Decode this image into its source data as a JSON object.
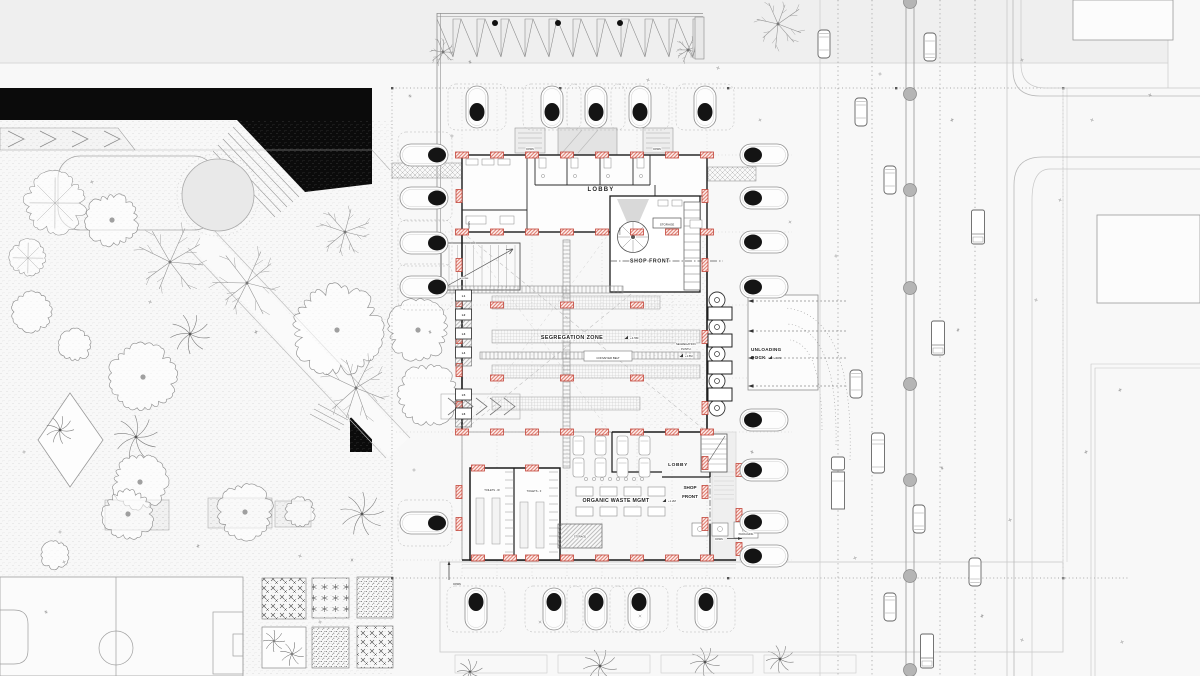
{
  "drawing": {
    "type": "architectural ground-floor site plan",
    "colors": {
      "ink": "#1b1b1b",
      "light_line": "#9a9a9a",
      "faint_line": "#c8c8c8",
      "column_red": "#c2453a",
      "column_red_fill": "#fdeeec",
      "gray_fill": "#e6e6e6",
      "band_gray": "#efefef",
      "median_circle": "#b5b5b5",
      "black_mass": "#0b0b0b"
    }
  },
  "labels": [
    {
      "id": "lobby-upper",
      "text": "LOBBY",
      "x": 601,
      "y": 191,
      "size": 6,
      "weight": 700,
      "spacing": 1.2,
      "halo": true
    },
    {
      "id": "storage-upper",
      "text": "STORAGE",
      "x": 667,
      "y": 225.5,
      "size": 3,
      "weight": 400
    },
    {
      "id": "shop-front-upper",
      "text": "SHOP FRONT",
      "x": 650,
      "y": 262.5,
      "size": 5.2,
      "weight": 700,
      "spacing": 0.6,
      "halo": true
    },
    {
      "id": "segregation-zone",
      "text": "SEGREGATION ZONE",
      "x": 572,
      "y": 339,
      "size": 5.4,
      "weight": 700,
      "spacing": 0.4,
      "halo": true
    },
    {
      "id": "segregation-zone-level",
      "text": "+1.5M",
      "x": 630,
      "y": 339,
      "size": 3,
      "weight": 400,
      "anchor": "start",
      "flag": true,
      "halo": true
    },
    {
      "id": "conveyer-belt",
      "text": "CONVEYER BELT",
      "x": 608,
      "y": 358.8,
      "size": 2.8,
      "weight": 400
    },
    {
      "id": "segregation-plinth-1",
      "text": "SEGREGATION",
      "x": 676,
      "y": 345,
      "size": 2.7,
      "weight": 400,
      "anchor": "start",
      "halo": true
    },
    {
      "id": "segregation-plinth-2",
      "text": "PLINTH",
      "x": 681,
      "y": 350,
      "size": 2.7,
      "weight": 400,
      "anchor": "start",
      "halo": true
    },
    {
      "id": "segregation-plinth-level",
      "text": "+1.5M",
      "x": 685,
      "y": 357,
      "size": 2.7,
      "weight": 400,
      "anchor": "start",
      "flag": true,
      "halo": true
    },
    {
      "id": "unloading-dock-1",
      "text": "UNLOADING",
      "x": 751,
      "y": 351,
      "size": 4.6,
      "weight": 700,
      "anchor": "start",
      "spacing": 0.3
    },
    {
      "id": "unloading-dock-2",
      "text": "DOCK",
      "x": 751,
      "y": 359,
      "size": 4.6,
      "weight": 700,
      "anchor": "start",
      "spacing": 0.3
    },
    {
      "id": "unloading-dock-level",
      "text": "+0.0M",
      "x": 774,
      "y": 359,
      "size": 2.6,
      "weight": 400,
      "anchor": "start",
      "flag": true
    },
    {
      "id": "organic-waste",
      "text": "ORGANIC WASTE MGMT",
      "x": 616,
      "y": 502,
      "size": 5.2,
      "weight": 700,
      "spacing": 0.3,
      "halo": true
    },
    {
      "id": "organic-waste-level",
      "text": "+1.2M",
      "x": 668,
      "y": 502,
      "size": 2.8,
      "weight": 400,
      "anchor": "start",
      "flag": true,
      "halo": true
    },
    {
      "id": "lobby-lower",
      "text": "LOBBY",
      "x": 678,
      "y": 466,
      "size": 4.8,
      "weight": 700,
      "spacing": 0.6,
      "halo": true
    },
    {
      "id": "shop-front-lower-1",
      "text": "SHOP",
      "x": 690,
      "y": 489,
      "size": 4.6,
      "weight": 700,
      "halo": true
    },
    {
      "id": "shop-front-lower-2",
      "text": "FRONT",
      "x": 690,
      "y": 498,
      "size": 4.6,
      "weight": 700,
      "halo": true
    },
    {
      "id": "toilets-w",
      "text": "TOILETS - W",
      "x": 492,
      "y": 491,
      "size": 2.6,
      "weight": 400,
      "halo": true
    },
    {
      "id": "toilets-f",
      "text": "TOILETS - F",
      "x": 534,
      "y": 492,
      "size": 2.6,
      "weight": 400,
      "halo": true
    },
    {
      "id": "storage-lower",
      "text": "STORAGE",
      "x": 580,
      "y": 537.5,
      "size": 2.5,
      "weight": 400,
      "halo": true
    },
    {
      "id": "packaging",
      "text": "PACKAGING",
      "x": 746,
      "y": 535,
      "size": 2.5,
      "weight": 400,
      "halo": true
    },
    {
      "id": "down-canopy-left",
      "text": "DOWN",
      "x": 530,
      "y": 150,
      "size": 2.4,
      "weight": 400,
      "halo": true
    },
    {
      "id": "down-canopy-right",
      "text": "DOWN",
      "x": 657,
      "y": 150,
      "size": 2.4,
      "weight": 400,
      "halo": true
    },
    {
      "id": "down-ramp",
      "text": "DOWN",
      "x": 470,
      "y": 225,
      "size": 2.4,
      "weight": 400,
      "rotate": -90
    },
    {
      "id": "down-core",
      "text": "DOWN",
      "x": 620.5,
      "y": 231,
      "size": 2.2,
      "weight": 400,
      "rotate": -90
    },
    {
      "id": "down-wall",
      "text": "DOWN",
      "x": 465,
      "y": 279,
      "size": 2.1,
      "weight": 400,
      "halo": true
    },
    {
      "id": "down-south",
      "text": "DOWN",
      "x": 457,
      "y": 585,
      "size": 2.4,
      "weight": 400
    },
    {
      "id": "down-east",
      "text": "DOWN",
      "x": 719,
      "y": 540,
      "size": 2.4,
      "weight": 400,
      "halo": true
    }
  ],
  "lift_cells": {
    "x": 463.5,
    "labels": [
      {
        "t": "L1",
        "y": 296
      },
      {
        "t": "L2",
        "y": 315
      },
      {
        "t": "L3",
        "y": 334
      },
      {
        "t": "L4",
        "y": 353
      },
      {
        "t": "L5",
        "y": 395
      },
      {
        "t": "L6",
        "y": 414
      }
    ]
  },
  "columns": {
    "horizontal": [
      [
        462,
        155
      ],
      [
        497,
        155
      ],
      [
        532,
        155
      ],
      [
        567,
        155
      ],
      [
        602,
        155
      ],
      [
        637,
        155
      ],
      [
        672,
        155
      ],
      [
        707,
        155
      ],
      [
        462,
        232
      ],
      [
        497,
        232
      ],
      [
        532,
        232
      ],
      [
        567,
        232
      ],
      [
        602,
        232
      ],
      [
        637,
        232
      ],
      [
        672,
        232
      ],
      [
        707,
        232
      ],
      [
        497,
        305
      ],
      [
        567,
        305
      ],
      [
        637,
        305
      ],
      [
        497,
        378
      ],
      [
        567,
        378
      ],
      [
        637,
        378
      ],
      [
        462,
        432
      ],
      [
        497,
        432
      ],
      [
        532,
        432
      ],
      [
        567,
        432
      ],
      [
        602,
        432
      ],
      [
        637,
        432
      ],
      [
        672,
        432
      ],
      [
        707,
        432
      ],
      [
        478,
        468
      ],
      [
        532,
        468
      ],
      [
        478,
        558
      ],
      [
        510,
        558
      ],
      [
        532,
        558
      ],
      [
        567,
        558
      ],
      [
        602,
        558
      ],
      [
        637,
        558
      ],
      [
        672,
        558
      ],
      [
        707,
        558
      ]
    ],
    "vertical": [
      [
        459,
        196
      ],
      [
        459,
        265
      ],
      [
        459,
        300
      ],
      [
        459,
        337
      ],
      [
        459,
        370
      ],
      [
        459,
        408
      ],
      [
        459,
        492
      ],
      [
        459,
        524
      ],
      [
        705,
        196
      ],
      [
        705,
        265
      ],
      [
        705,
        337
      ],
      [
        705,
        408
      ],
      [
        705,
        463
      ],
      [
        705,
        492
      ],
      [
        705,
        524
      ],
      [
        739,
        470
      ],
      [
        739,
        515
      ],
      [
        739,
        549
      ]
    ]
  },
  "site_trees": {
    "top": {
      "xs": [
        477,
        552,
        596,
        640,
        705
      ]
    },
    "bottom": {
      "xs": [
        476,
        554,
        596,
        639,
        706
      ]
    },
    "left": {
      "ys": [
        155,
        198,
        243,
        287,
        523
      ]
    },
    "right": {
      "ys": [
        155,
        198,
        242,
        287,
        420,
        470,
        522,
        556
      ]
    }
  },
  "park_trees": [
    {
      "x": 55,
      "y": 203,
      "r": 30,
      "t": "flower"
    },
    {
      "x": 112,
      "y": 220,
      "r": 26,
      "t": "blob",
      "dot": true
    },
    {
      "x": 28,
      "y": 258,
      "r": 18,
      "t": "flower"
    },
    {
      "x": 32,
      "y": 312,
      "r": 20,
      "t": "blob"
    },
    {
      "x": 75,
      "y": 345,
      "r": 16,
      "t": "blob"
    },
    {
      "x": 170,
      "y": 262,
      "r": 38,
      "t": "branch"
    },
    {
      "x": 247,
      "y": 283,
      "r": 36,
      "t": "branch"
    },
    {
      "x": 190,
      "y": 334,
      "r": 20,
      "t": "palm"
    },
    {
      "x": 143,
      "y": 377,
      "r": 33,
      "t": "blob",
      "dot": true
    },
    {
      "x": 337,
      "y": 330,
      "r": 44,
      "t": "blob",
      "dot": true
    },
    {
      "x": 356,
      "y": 388,
      "r": 34,
      "t": "branch"
    },
    {
      "x": 136,
      "y": 437,
      "r": 22,
      "t": "palm"
    },
    {
      "x": 140,
      "y": 482,
      "r": 27,
      "t": "blob",
      "dot": true
    },
    {
      "x": 345,
      "y": 232,
      "r": 28,
      "t": "branch"
    },
    {
      "x": 128,
      "y": 514,
      "r": 25,
      "t": "blob",
      "dot": true
    },
    {
      "x": 245,
      "y": 512,
      "r": 27,
      "t": "blob",
      "dot": true
    },
    {
      "x": 300,
      "y": 512,
      "r": 15,
      "t": "blob"
    },
    {
      "x": 362,
      "y": 514,
      "r": 22,
      "t": "palm"
    },
    {
      "x": 55,
      "y": 555,
      "r": 14,
      "t": "blob"
    },
    {
      "x": 60,
      "y": 430,
      "r": 14,
      "t": "palm"
    },
    {
      "x": 418,
      "y": 330,
      "r": 30,
      "t": "blob",
      "dot": true
    },
    {
      "x": 428,
      "y": 395,
      "r": 30,
      "t": "blob"
    },
    {
      "x": 443,
      "y": 52,
      "r": 14,
      "t": "branch"
    },
    {
      "x": 688,
      "y": 50,
      "r": 13,
      "t": "branch"
    },
    {
      "x": 778,
      "y": 24,
      "r": 26,
      "t": "branch"
    },
    {
      "x": 470,
      "y": 672,
      "r": 13,
      "t": "palm"
    },
    {
      "x": 600,
      "y": 666,
      "r": 17,
      "t": "palm"
    },
    {
      "x": 705,
      "y": 662,
      "r": 15,
      "t": "palm"
    },
    {
      "x": 780,
      "y": 659,
      "r": 14,
      "t": "palm"
    }
  ],
  "vehicles": [
    {
      "x": 824,
      "y": 44,
      "type": "car",
      "dir": "down"
    },
    {
      "x": 930,
      "y": 47,
      "type": "car",
      "dir": "up"
    },
    {
      "x": 861,
      "y": 112,
      "type": "car",
      "dir": "down"
    },
    {
      "x": 890,
      "y": 180,
      "type": "car",
      "dir": "down"
    },
    {
      "x": 978,
      "y": 227,
      "type": "truck",
      "dir": "up"
    },
    {
      "x": 938,
      "y": 338,
      "type": "truck",
      "dir": "up"
    },
    {
      "x": 856,
      "y": 384,
      "type": "car",
      "dir": "down"
    },
    {
      "x": 878,
      "y": 453,
      "type": "bus",
      "dir": "down"
    },
    {
      "x": 838,
      "y": 483,
      "type": "trailer",
      "dir": "down"
    },
    {
      "x": 919,
      "y": 519,
      "type": "car",
      "dir": "up"
    },
    {
      "x": 975,
      "y": 572,
      "type": "car",
      "dir": "up"
    },
    {
      "x": 890,
      "y": 607,
      "type": "car",
      "dir": "down"
    },
    {
      "x": 927,
      "y": 651,
      "type": "truck",
      "dir": "up"
    }
  ],
  "median": {
    "x": 910,
    "r": 6.5,
    "ys": [
      2,
      94,
      190,
      288,
      384,
      480,
      576,
      670
    ]
  },
  "dock": {
    "turntable_x": 717,
    "turntable_r": 8,
    "turntable_ys": [
      300,
      327,
      354,
      381,
      408
    ],
    "bays": [
      [
        708,
        307
      ],
      [
        708,
        334
      ],
      [
        708,
        361
      ],
      [
        708,
        388
      ]
    ],
    "arrow_ys": [
      301,
      331,
      358,
      386
    ]
  },
  "garden_beds": [
    {
      "x": 262,
      "y": 578,
      "w": 44,
      "h": 41,
      "p": "A"
    },
    {
      "x": 312,
      "y": 578,
      "w": 37,
      "h": 40,
      "p": "B"
    },
    {
      "x": 357,
      "y": 577,
      "w": 36,
      "h": 41,
      "p": "C"
    },
    {
      "x": 262,
      "y": 627,
      "w": 44,
      "h": 41,
      "p": "palm"
    },
    {
      "x": 312,
      "y": 627,
      "w": 37,
      "h": 41,
      "p": "C"
    },
    {
      "x": 357,
      "y": 626,
      "w": 36,
      "h": 42,
      "p": "A"
    }
  ],
  "planters": [
    [
      105,
      500,
      64,
      30
    ],
    [
      208,
      498,
      64,
      30
    ],
    [
      275,
      501,
      36,
      26
    ]
  ],
  "scatter_marks": [
    [
      410,
      96
    ],
    [
      452,
      136
    ],
    [
      880,
      74
    ],
    [
      952,
      120
    ],
    [
      1022,
      60
    ],
    [
      836,
      256
    ],
    [
      958,
      330
    ],
    [
      1036,
      300
    ],
    [
      855,
      558
    ],
    [
      942,
      468
    ],
    [
      1092,
      120
    ],
    [
      1150,
      95
    ],
    [
      1086,
      452
    ],
    [
      1022,
      640
    ],
    [
      300,
      556
    ],
    [
      198,
      546
    ],
    [
      60,
      532
    ],
    [
      24,
      452
    ],
    [
      256,
      332
    ],
    [
      64,
      562
    ],
    [
      414,
      470
    ],
    [
      430,
      332
    ],
    [
      760,
      120
    ],
    [
      790,
      222
    ],
    [
      752,
      452
    ],
    [
      640,
      616
    ],
    [
      540,
      622
    ],
    [
      982,
      616
    ],
    [
      1122,
      642
    ],
    [
      320,
      622
    ],
    [
      46,
      612
    ],
    [
      150,
      302
    ],
    [
      92,
      182
    ],
    [
      352,
      560
    ],
    [
      648,
      80
    ],
    [
      718,
      68
    ],
    [
      470,
      62
    ],
    [
      1010,
      520
    ],
    [
      1060,
      200
    ],
    [
      1120,
      390
    ]
  ]
}
